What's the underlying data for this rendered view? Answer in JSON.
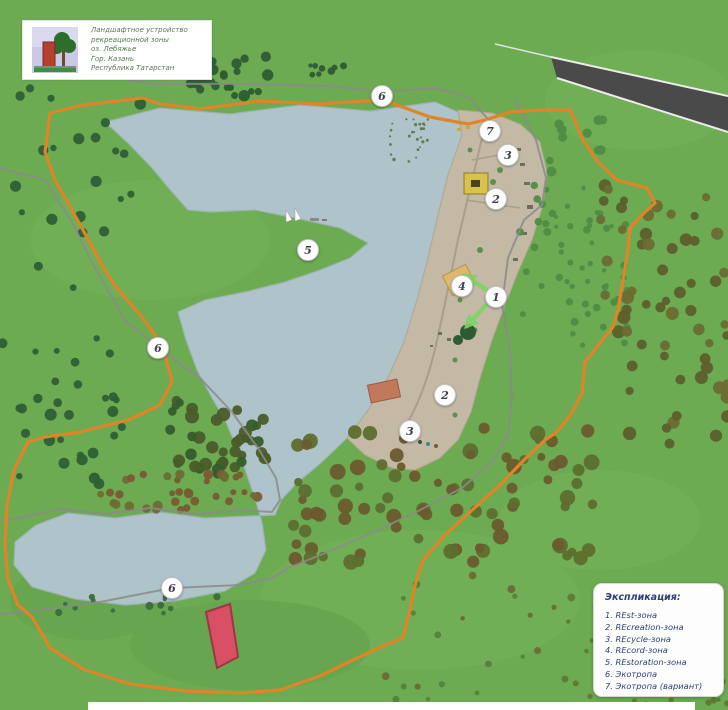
{
  "header": {
    "title_lines": [
      "Ландшафтное устройство",
      "рекреационной зоны",
      "оз. Лебяжье",
      "Гор. Казань",
      "Республика Татарстан"
    ]
  },
  "legend": {
    "title": "Экспликация:",
    "items": [
      "1. REst-зона",
      "2. REcreation-зона",
      "3. REcycle-зона",
      "4. REcord-зона",
      "5. REstoration-зона",
      "6. Экотропа",
      "7. Экотропа (вариант)"
    ]
  },
  "map": {
    "markers": [
      {
        "label": "6",
        "x": 382,
        "y": 96
      },
      {
        "label": "7",
        "x": 490,
        "y": 131
      },
      {
        "label": "3",
        "x": 508,
        "y": 155
      },
      {
        "label": "2",
        "x": 496,
        "y": 199
      },
      {
        "label": "5",
        "x": 308,
        "y": 250
      },
      {
        "label": "4",
        "x": 462,
        "y": 286
      },
      {
        "label": "1",
        "x": 496,
        "y": 297
      },
      {
        "label": "6",
        "x": 158,
        "y": 348
      },
      {
        "label": "2",
        "x": 445,
        "y": 395
      },
      {
        "label": "3",
        "x": 410,
        "y": 431
      },
      {
        "label": "6",
        "x": 172,
        "y": 588
      }
    ]
  },
  "colors": {
    "grass": "#6cab52",
    "lake": "#afc3cb",
    "beach": "#c3b9a5",
    "trail_orange": "#e08428",
    "trail_gray": "#8b8b8b",
    "road": "#4a4a4a",
    "building_red": "#d94f63",
    "building_salmon": "#c1795b",
    "building_tan": "#d9ba6e",
    "building_yellow": "#d8c34a",
    "arrow_green": "#7fd463",
    "legend_text": "#2e3f70",
    "title_text": "#567a4e"
  }
}
